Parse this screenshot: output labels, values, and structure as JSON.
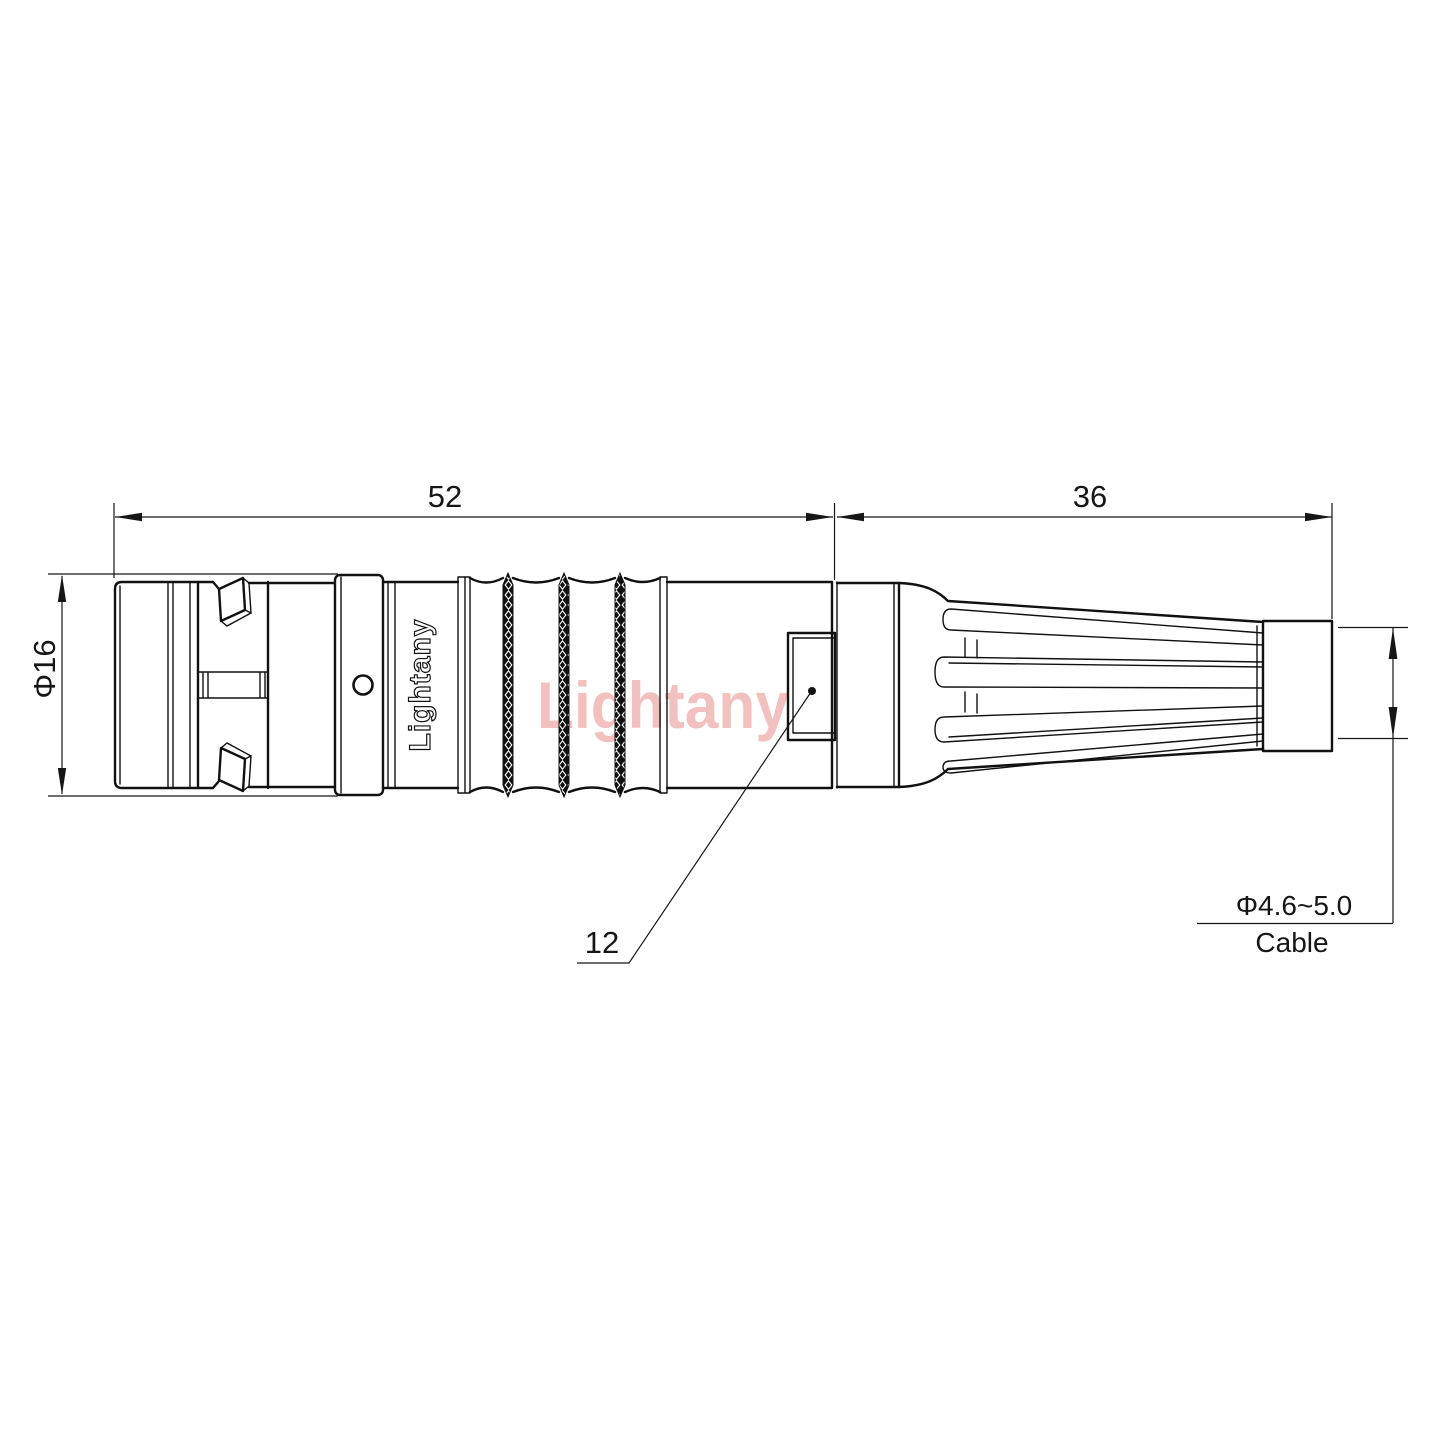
{
  "watermark": {
    "text": "Lightany",
    "color": "#f3c0c0"
  },
  "connector": {
    "brand_text": "Lightany"
  },
  "dimensions": {
    "front_length": {
      "value": "52"
    },
    "rear_length": {
      "value": "36"
    },
    "front_diameter": {
      "value": "Φ16"
    },
    "coupling_diameter": {
      "value": "12"
    },
    "cable_diameter": {
      "value": "Φ4.6~5.0",
      "label": "Cable"
    }
  },
  "colors": {
    "line": "#111111",
    "background": "#ffffff",
    "watermark": "#f3c0c0",
    "knurl_fill": "#101010"
  }
}
